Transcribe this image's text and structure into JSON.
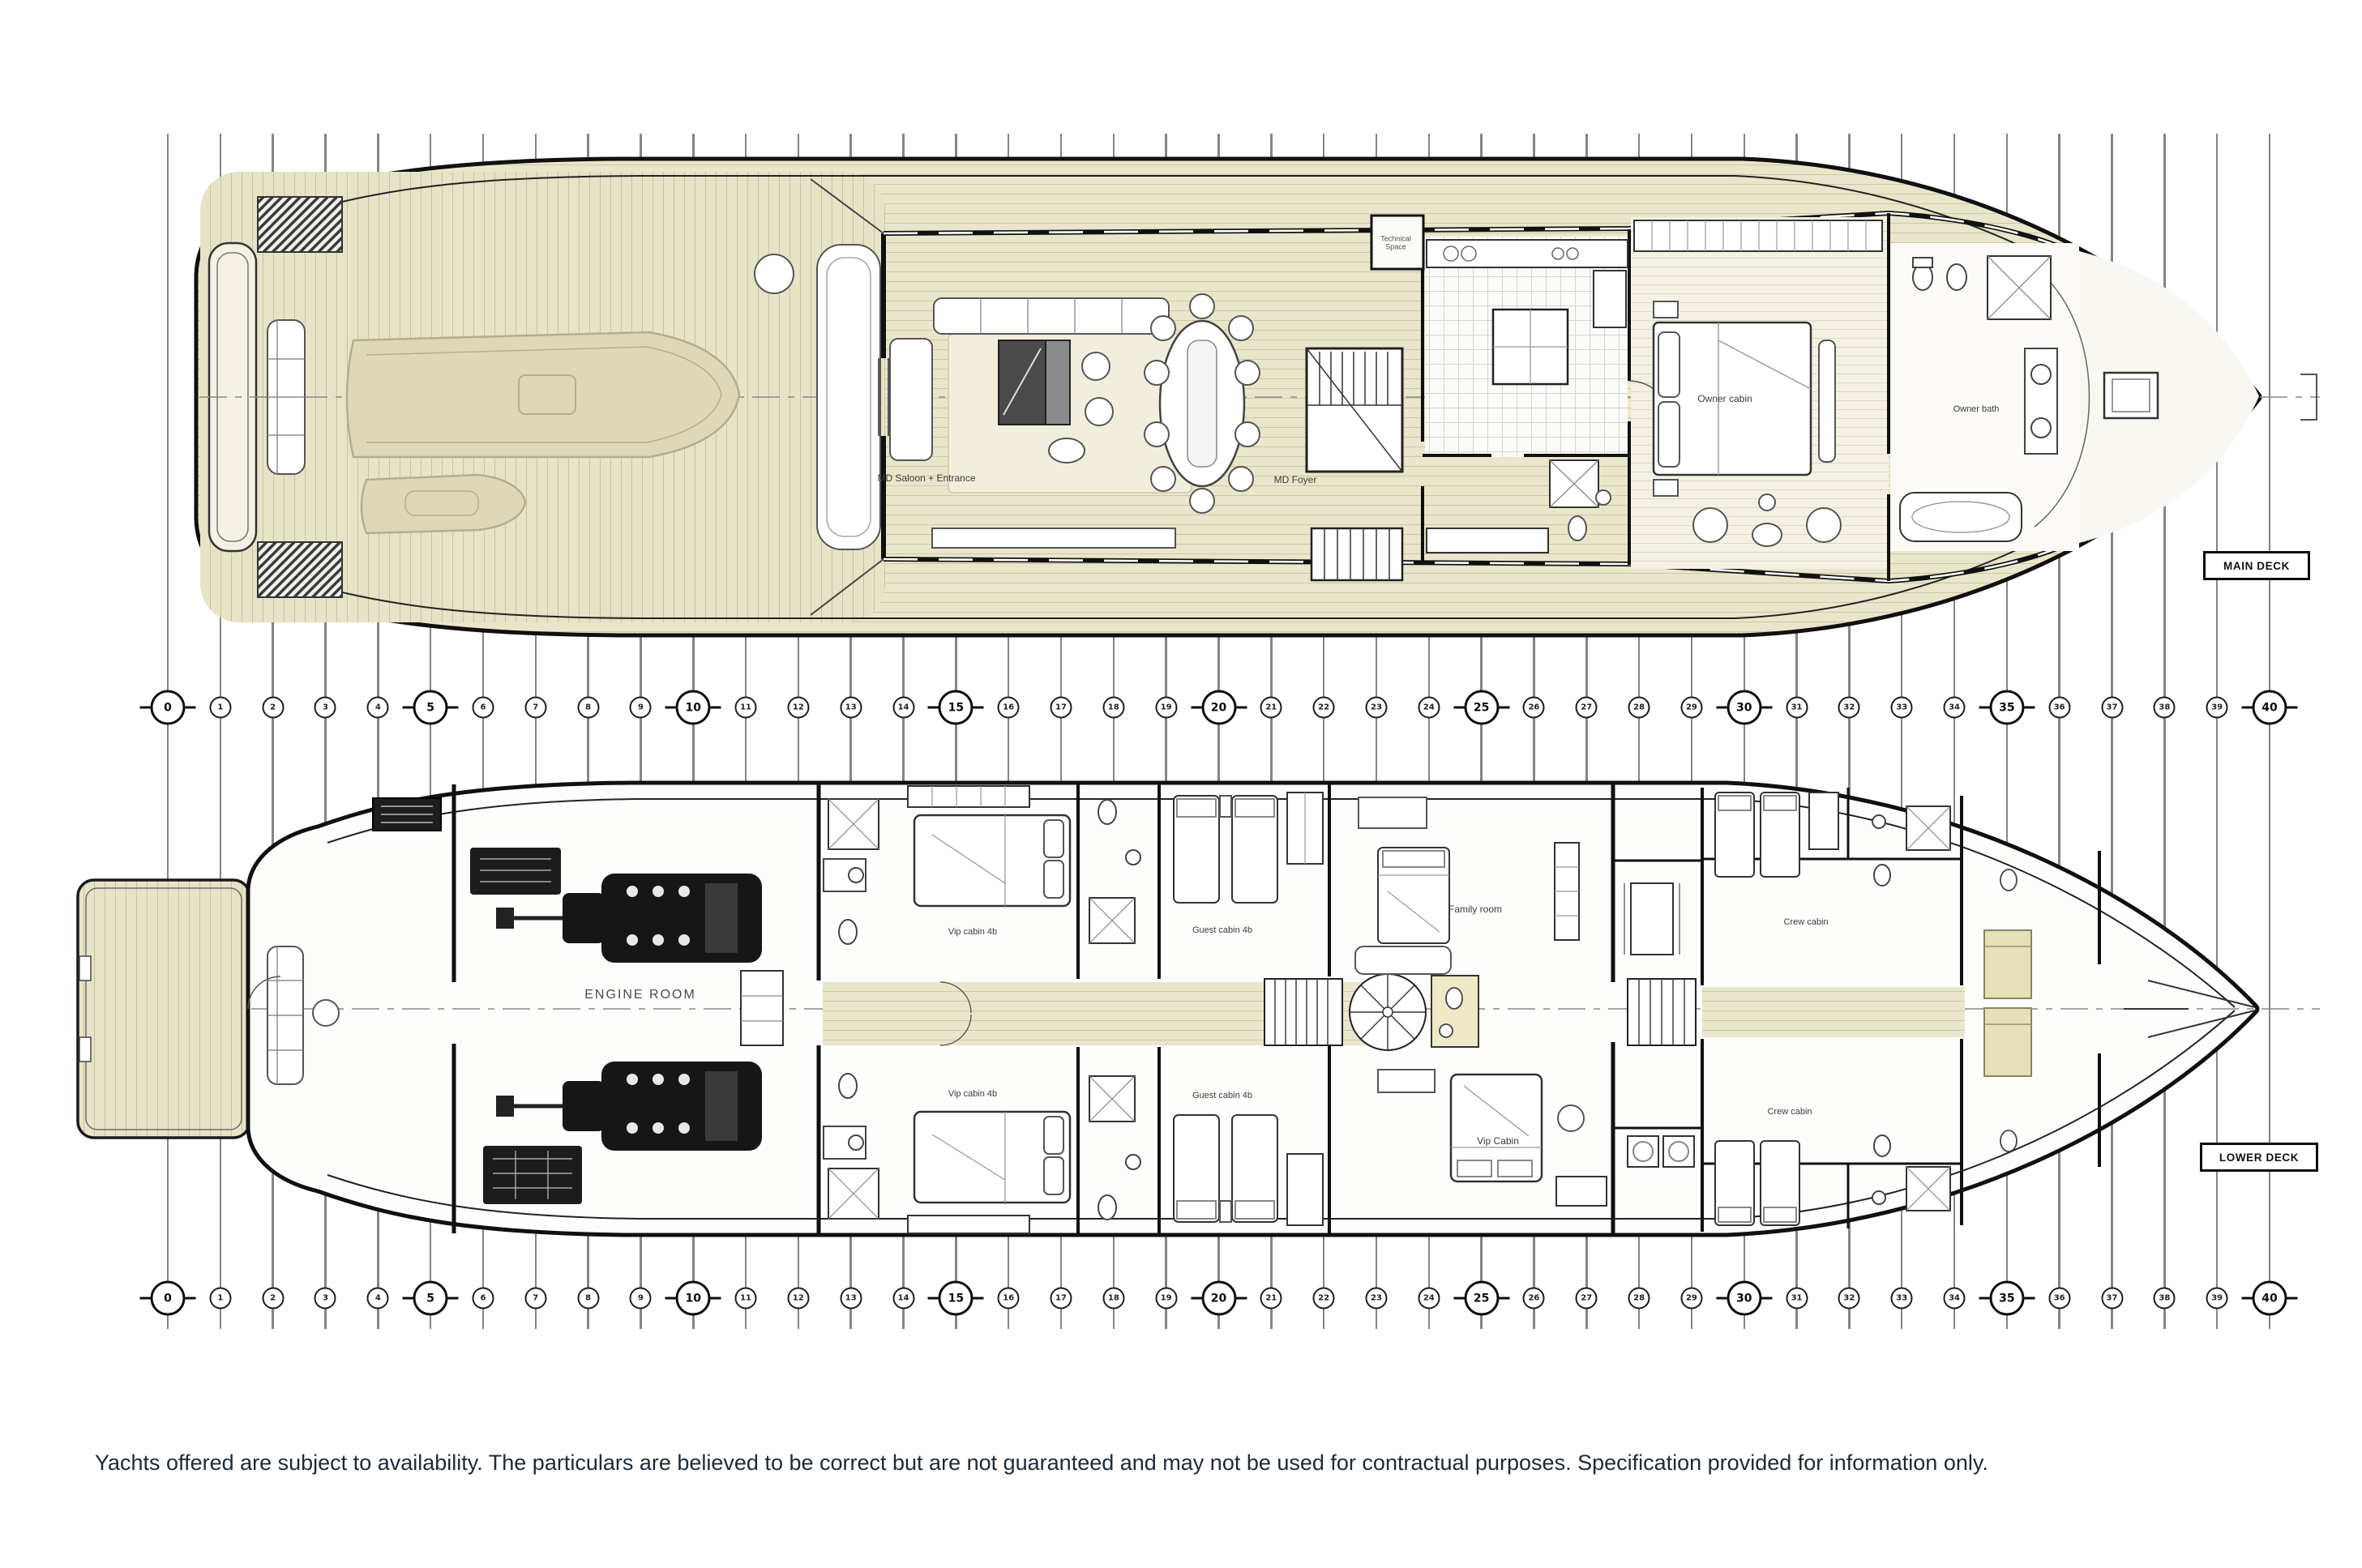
{
  "disclaimer": "Yachts offered are subject to availability. The particulars are believed to be correct but are not guaranteed and may not be used for contractual purposes. Specification provided for information only.",
  "decks": {
    "main": {
      "tag": "MAIN DECK"
    },
    "lower": {
      "tag": "LOWER DECK"
    }
  },
  "stations": {
    "min": 0,
    "max": 40,
    "major_step": 5,
    "major_labels": [
      0,
      5,
      10,
      15,
      20,
      25,
      30,
      35,
      40
    ]
  },
  "labels": {
    "main": {
      "technical_space": "Technical Space",
      "saloon": "MD Saloon + Entrance",
      "foyer": "MD Foyer",
      "owner_cabin": "Owner cabin",
      "owner_bath": "Owner bath"
    },
    "lower": {
      "engine_room": "ENGINE ROOM",
      "vip_ps": "Vip cabin 4b",
      "vip_sb": "Vip cabin 4b",
      "guest_ps": "Guest cabin 4b",
      "guest_sb": "Guest cabin 4b",
      "family": "Family room",
      "vip": "Vip Cabin",
      "crew1": "Crew cabin",
      "crew2": "Crew cabin"
    }
  },
  "colors": {
    "teak": "#e9e5c9",
    "plank_line": "#cdc7a6",
    "wall": "#101010",
    "station_line": "#858585",
    "ghost_tender": "#ddd8ba",
    "disclaimer_text": "#1d2a36"
  }
}
